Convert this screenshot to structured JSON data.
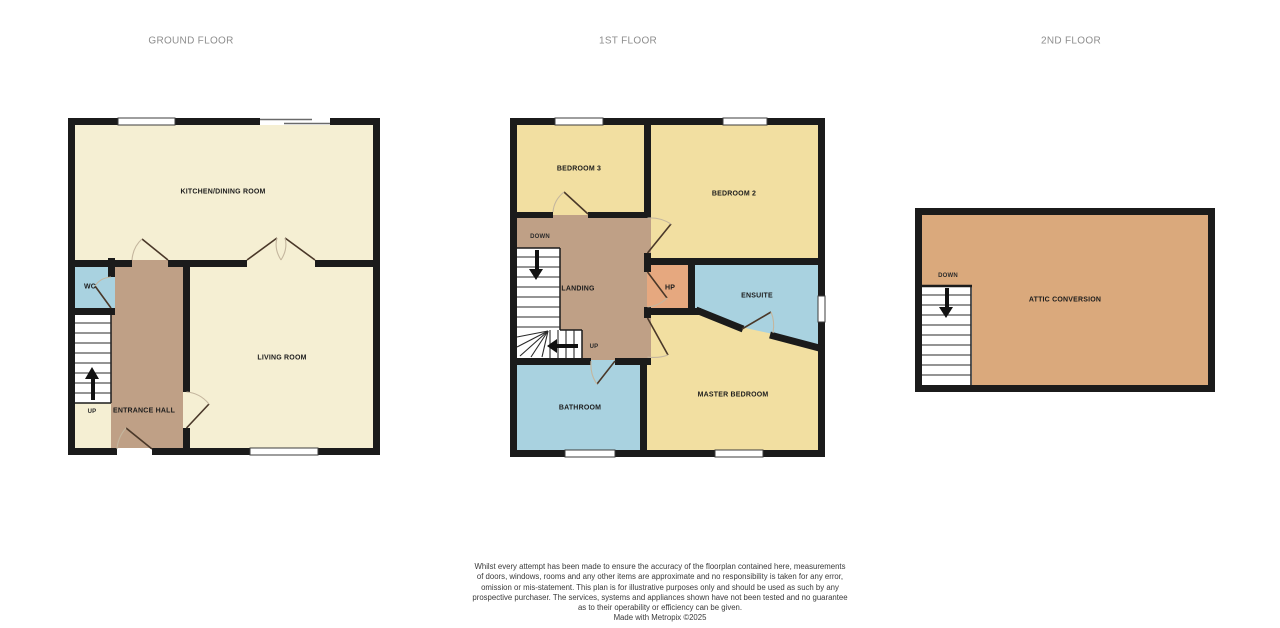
{
  "floors": [
    {
      "title": "GROUND FLOOR",
      "rooms": [
        {
          "label": "KITCHEN/DINING ROOM"
        },
        {
          "label": "WC"
        },
        {
          "label": "LIVING ROOM"
        },
        {
          "label": "ENTRANCE HALL"
        }
      ],
      "stairs": {
        "up_label": "UP"
      }
    },
    {
      "title": "1ST FLOOR",
      "rooms": [
        {
          "label": "BEDROOM 3"
        },
        {
          "label": "BEDROOM 2"
        },
        {
          "label": "LANDING"
        },
        {
          "label": "HP"
        },
        {
          "label": "ENSUITE"
        },
        {
          "label": "BATHROOM"
        },
        {
          "label": "MASTER BEDROOM"
        }
      ],
      "stairs": {
        "down_label": "DOWN",
        "up_label": "UP"
      }
    },
    {
      "title": "2ND FLOOR",
      "rooms": [
        {
          "label": "ATTIC CONVERSION"
        }
      ],
      "stairs": {
        "down_label": "DOWN"
      }
    }
  ],
  "disclaimer": {
    "lines": [
      "Whilst every attempt has been made to ensure the accuracy of the floorplan contained here, measurements",
      "of doors, windows, rooms and any other items are approximate and no responsibility is taken for any error,",
      "omission or mis-statement. This plan is for illustrative purposes only and should be used as such by any",
      "prospective purchaser. The services, systems and appliances shown have not been tested and no guarantee",
      "as to their operability or efficiency can be given.",
      "Made with Metropix ©2025"
    ]
  },
  "colors": {
    "wall": "#1b1b1b",
    "room_cream": "#f5efd3",
    "room_yellow": "#f2dfa1",
    "room_blue": "#a9d2e0",
    "room_tan": "#bfa086",
    "room_hp_orange": "#e6a87f",
    "room_attic_orange": "#daa97c",
    "window_white": "#ffffff",
    "door_leaf": "#4a3829",
    "door_arc": "#c4b69e",
    "title_text": "#8d8d8d",
    "disclaimer_text": "#3a3a3a"
  }
}
